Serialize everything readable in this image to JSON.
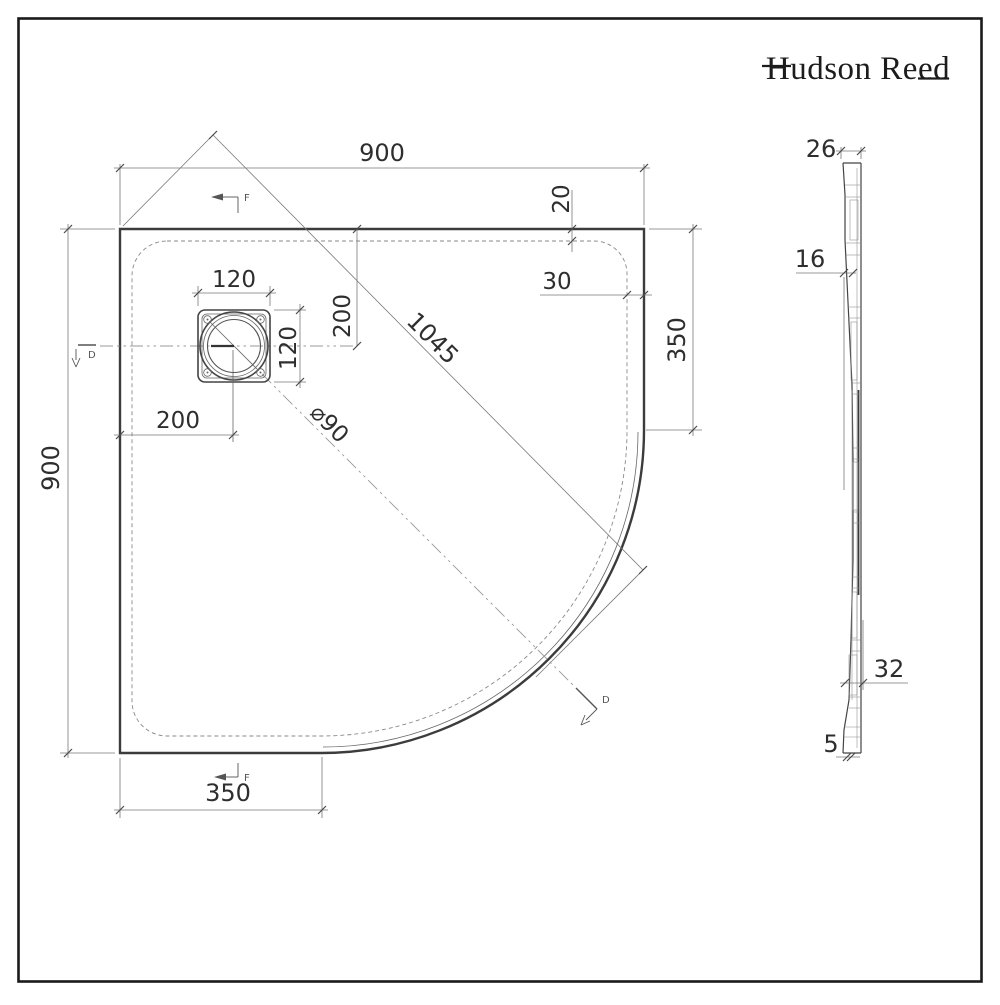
{
  "logo": {
    "text": "Hudson Reed"
  },
  "plan_view": {
    "dims": {
      "top_width": "900",
      "left_height": "900",
      "right_corner_height": "350",
      "bottom_corner_width": "350",
      "rim_top": "20",
      "rim_right": "30",
      "diagonal": "1045",
      "drain_width": "120",
      "drain_height": "120",
      "drain_offset_top": "200",
      "drain_offset_left": "200",
      "drain_diameter": "⌀90"
    },
    "markers": {
      "d": "D",
      "f": "F"
    }
  },
  "side_view": {
    "dims": {
      "top_thickness": "26",
      "mid_thickness": "16",
      "bottom_depth": "32",
      "bottom_lip": "5"
    }
  },
  "colors": {
    "line": "#3c3c3c",
    "dim_line": "#787878",
    "background": "#ffffff"
  }
}
